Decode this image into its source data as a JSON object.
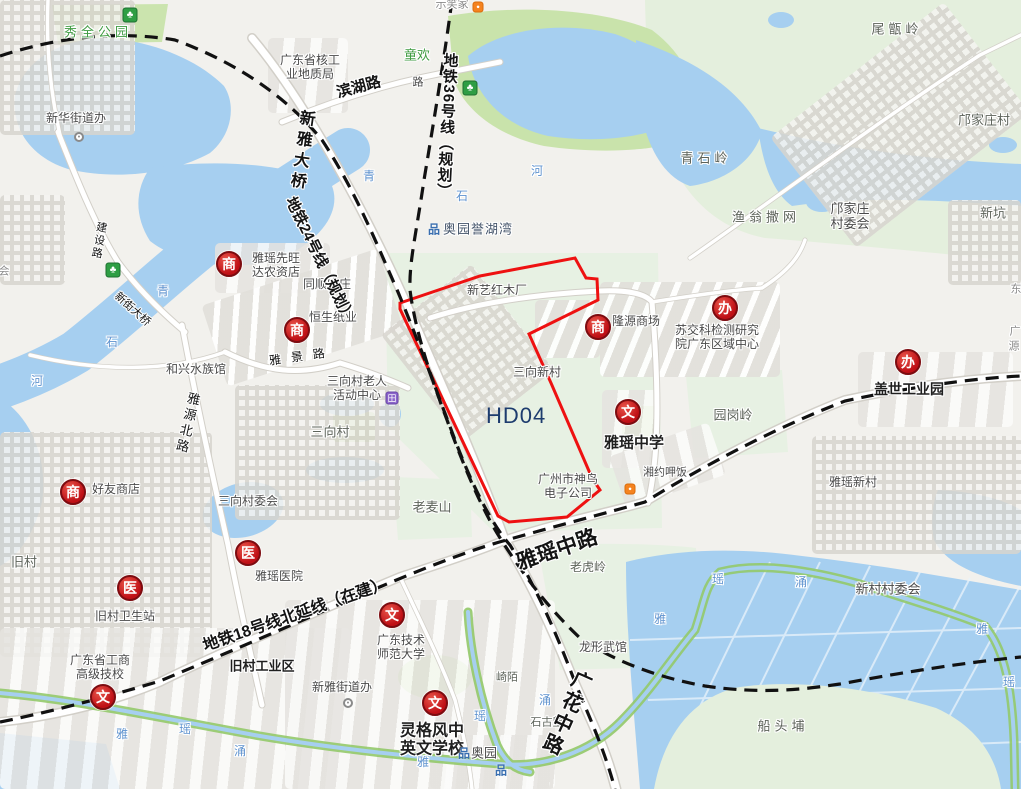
{
  "map": {
    "zone": {
      "code": "HD04",
      "boundary_color": "#ee1111",
      "label_color": "#1d3c6e"
    },
    "metro_lines": [
      {
        "label": "地铁24号线（规划）"
      },
      {
        "label": "地铁36号线（规划）"
      },
      {
        "label": "地铁18号线北延线（在建）"
      }
    ],
    "roads": [
      {
        "label": "滨湖路"
      },
      {
        "label": "新雅大桥"
      },
      {
        "label": "建设路"
      },
      {
        "label": "新街大桥"
      },
      {
        "label": "雅源北路"
      },
      {
        "label": "雅景路"
      },
      {
        "label": "雅瑶中路"
      },
      {
        "label": "广花中路"
      }
    ],
    "colors": {
      "water": "#a6cff0",
      "park_green": "#c9e3ab",
      "hill_green": "#e7f1e3",
      "poi_icon_red": "#bf1016"
    },
    "labels": [
      {
        "n": "xiuquan-park",
        "t": "秀全公园",
        "x": 98,
        "y": 33,
        "c": "green sp"
      },
      {
        "n": "xinhua-street-office",
        "t": "新华街道办",
        "x": 76,
        "y": 119,
        "c": ""
      },
      {
        "n": "nuclear-geology-bureau",
        "t": "广东省核工\n业地质局",
        "x": 310,
        "y": 68,
        "c": "pre"
      },
      {
        "n": "tonghuan",
        "t": "童欢",
        "x": 417,
        "y": 56,
        "c": "green"
      },
      {
        "n": "top-edge-clipped",
        "t": "示笑家",
        "x": 452,
        "y": 5,
        "c": "clip"
      },
      {
        "n": "small-road-char",
        "t": "路",
        "x": 418,
        "y": 83,
        "c": "",
        "fs": 11
      },
      {
        "n": "aoyuan-yuhuwan",
        "t": "奥园誉湖湾",
        "x": 478,
        "y": 230,
        "c": "slate"
      },
      {
        "n": "weizengling-hill",
        "t": "尾甑岭",
        "x": 897,
        "y": 30,
        "c": "place sp"
      },
      {
        "n": "kuangjiazhuang-village",
        "t": "邝家庄村",
        "x": 984,
        "y": 121,
        "c": "place"
      },
      {
        "n": "qingshiling-hill",
        "t": "青石岭",
        "x": 706,
        "y": 159,
        "c": "place sp"
      },
      {
        "n": "yuweng-sawang",
        "t": "渔翁撒网",
        "x": 766,
        "y": 218,
        "c": "place sp"
      },
      {
        "n": "kuangjiazhuang-committee",
        "t": "邝家庄\n村委会",
        "x": 850,
        "y": 217,
        "c": "pre",
        "fs": 13
      },
      {
        "n": "xinkeng",
        "t": "新坑",
        "x": 993,
        "y": 214,
        "c": "place"
      },
      {
        "n": "yayao-xianwangda-store",
        "t": "雅瑶先旺\n达农资店",
        "x": 276,
        "y": 266,
        "c": "pre"
      },
      {
        "n": "tongshun-farm",
        "t": "同顺农庄",
        "x": 327,
        "y": 285,
        "c": ""
      },
      {
        "n": "hengsheng-paper",
        "t": "恒生纸业",
        "x": 333,
        "y": 318,
        "c": ""
      },
      {
        "n": "xinyi-redwood-factory",
        "t": "新艺红木厂",
        "x": 497,
        "y": 291,
        "c": ""
      },
      {
        "n": "sanxiang-xincun",
        "t": "三向新村",
        "x": 537,
        "y": 373,
        "c": ""
      },
      {
        "n": "longyuan-mall",
        "t": "隆源商场",
        "x": 636,
        "y": 322,
        "c": ""
      },
      {
        "n": "sujiaoke-center",
        "t": "苏交科检测研究\n院广东区域中心",
        "x": 717,
        "y": 338,
        "c": "pre"
      },
      {
        "n": "hexing-aquarium",
        "t": "和兴水族馆",
        "x": 196,
        "y": 370,
        "c": ""
      },
      {
        "n": "elderly-activity-center",
        "t": "三向村老人\n活动中心",
        "x": 357,
        "y": 389,
        "c": "pre"
      },
      {
        "n": "sanxiang-village",
        "t": "三向村",
        "x": 330,
        "y": 433,
        "c": "place"
      },
      {
        "n": "yuangangling-hill",
        "t": "园岗岭",
        "x": 733,
        "y": 416,
        "c": "place"
      },
      {
        "n": "yayao-middle-school",
        "t": "雅瑶中学",
        "x": 634,
        "y": 443,
        "c": "big"
      },
      {
        "n": "gaishi-industrial-park",
        "t": "盖世工业园",
        "x": 909,
        "y": 389,
        "c": "big",
        "fs": 14
      },
      {
        "n": "haoyou-store",
        "t": "好友商店",
        "x": 116,
        "y": 490,
        "c": ""
      },
      {
        "n": "sanxiang-committee",
        "t": "三向村委会",
        "x": 248,
        "y": 502,
        "c": ""
      },
      {
        "n": "jiucun-village",
        "t": "旧村",
        "x": 24,
        "y": 563,
        "c": "place"
      },
      {
        "n": "yayao-hospital",
        "t": "雅瑶医院",
        "x": 279,
        "y": 577,
        "c": ""
      },
      {
        "n": "jiucun-clinic",
        "t": "旧村卫生站",
        "x": 125,
        "y": 617,
        "c": ""
      },
      {
        "n": "shenniao-electronics",
        "t": "广州市神鸟\n电子公司",
        "x": 568,
        "y": 487,
        "c": "pre"
      },
      {
        "n": "xiangyue-restaurant",
        "t": "湘约呷饭",
        "x": 665,
        "y": 473,
        "c": "",
        "fs": 11
      },
      {
        "n": "yayao-xincun",
        "t": "雅瑶新村",
        "x": 853,
        "y": 483,
        "c": ""
      },
      {
        "n": "xincun-committee",
        "t": "新村村委会",
        "x": 888,
        "y": 590,
        "c": "",
        "fs": 13
      },
      {
        "n": "chuantoubu",
        "t": "船头埔",
        "x": 783,
        "y": 727,
        "c": "place sp"
      },
      {
        "n": "laohuling-hill",
        "t": "老虎岭",
        "x": 588,
        "y": 568,
        "c": "place",
        "fs": 12
      },
      {
        "n": "longxing-martial-hall",
        "t": "龙形武馆",
        "x": 603,
        "y": 648,
        "c": ""
      },
      {
        "n": "laomaishan-hill",
        "t": "老麦山",
        "x": 432,
        "y": 508,
        "c": "place"
      },
      {
        "n": "qimo",
        "t": "崎陌",
        "x": 507,
        "y": 678,
        "c": "place",
        "fs": 11
      },
      {
        "n": "shigulang",
        "t": "石古塱",
        "x": 547,
        "y": 723,
        "c": "place",
        "fs": 11
      },
      {
        "n": "gongshang-technical-school",
        "t": "广东省工商\n高级技校",
        "x": 100,
        "y": 668,
        "c": "pre"
      },
      {
        "n": "jiucun-industrial-zone",
        "t": "旧村工业区",
        "x": 262,
        "y": 667,
        "c": "big",
        "fs": 13
      },
      {
        "n": "xinya-street-office",
        "t": "新雅街道办",
        "x": 342,
        "y": 688,
        "c": ""
      },
      {
        "n": "normal-university",
        "t": "广东技术\n师范大学",
        "x": 401,
        "y": 648,
        "c": "pre"
      },
      {
        "n": "linggefeng-school",
        "t": "灵格风中\n英文学校",
        "x": 432,
        "y": 741,
        "c": "big pre",
        "fs": 16
      },
      {
        "n": "aoyuan",
        "t": "奥园",
        "x": 484,
        "y": 754,
        "c": "",
        "fs": 13
      },
      {
        "n": "water-qing-1",
        "t": "青",
        "x": 369,
        "y": 177,
        "c": "blue"
      },
      {
        "n": "water-shi-1",
        "t": "石",
        "x": 462,
        "y": 197,
        "c": "blue"
      },
      {
        "n": "water-he-1",
        "t": "河",
        "x": 537,
        "y": 172,
        "c": "blue"
      },
      {
        "n": "water-qing-2",
        "t": "青",
        "x": 163,
        "y": 292,
        "c": "blue"
      },
      {
        "n": "water-shi-2",
        "t": "石",
        "x": 112,
        "y": 343,
        "c": "blue"
      },
      {
        "n": "water-he-2",
        "t": "河",
        "x": 37,
        "y": 382,
        "c": "blue"
      },
      {
        "n": "water-yao-1",
        "t": "瑶",
        "x": 718,
        "y": 580,
        "c": "blue"
      },
      {
        "n": "water-chong-1",
        "t": "涌",
        "x": 801,
        "y": 583,
        "c": "blue"
      },
      {
        "n": "water-ya-1",
        "t": "雅",
        "x": 660,
        "y": 620,
        "c": "blue"
      },
      {
        "n": "water-ya-2",
        "t": "雅",
        "x": 982,
        "y": 630,
        "c": "blue"
      },
      {
        "n": "water-yao-2",
        "t": "瑶",
        "x": 1009,
        "y": 683,
        "c": "blue"
      },
      {
        "n": "water-chong-2",
        "t": "涌",
        "x": 545,
        "y": 701,
        "c": "blue"
      },
      {
        "n": "water-yao-3",
        "t": "瑶",
        "x": 480,
        "y": 717,
        "c": "blue"
      },
      {
        "n": "water-ya-3",
        "t": "雅",
        "x": 423,
        "y": 763,
        "c": "blue"
      },
      {
        "n": "water-ya-4",
        "t": "雅",
        "x": 122,
        "y": 735,
        "c": "blue"
      },
      {
        "n": "water-yao-4",
        "t": "瑶",
        "x": 185,
        "y": 730,
        "c": "blue"
      },
      {
        "n": "water-chong-3",
        "t": "涌",
        "x": 240,
        "y": 752,
        "c": "blue"
      },
      {
        "n": "left-edge-clipped",
        "t": "会",
        "x": 4,
        "y": 272,
        "c": "clip"
      },
      {
        "n": "right-edge-clipped-1",
        "t": "东",
        "x": 1016,
        "y": 290,
        "c": "clip"
      },
      {
        "n": "right-edge-clipped-2",
        "t": "广",
        "x": 1015,
        "y": 332,
        "c": "clip"
      },
      {
        "n": "right-edge-clipped-3",
        "t": "源",
        "x": 1014,
        "y": 347,
        "c": "clip"
      }
    ],
    "icons": [
      {
        "k": "red",
        "g": "商",
        "x": 229,
        "y": 264,
        "n": "commerce-icon-1"
      },
      {
        "k": "red",
        "g": "商",
        "x": 297,
        "y": 330,
        "n": "commerce-icon-2"
      },
      {
        "k": "red",
        "g": "商",
        "x": 598,
        "y": 327,
        "n": "commerce-icon-3"
      },
      {
        "k": "red",
        "g": "商",
        "x": 73,
        "y": 492,
        "n": "commerce-icon-4"
      },
      {
        "k": "red",
        "g": "医",
        "x": 248,
        "y": 553,
        "n": "hospital-icon-1"
      },
      {
        "k": "red",
        "g": "医",
        "x": 130,
        "y": 588,
        "n": "hospital-icon-2"
      },
      {
        "k": "red",
        "g": "办",
        "x": 725,
        "y": 308,
        "n": "office-icon-1"
      },
      {
        "k": "red",
        "g": "办",
        "x": 908,
        "y": 362,
        "n": "office-icon-2"
      },
      {
        "k": "red",
        "g": "文",
        "x": 628,
        "y": 412,
        "n": "culture-icon-1"
      },
      {
        "k": "red",
        "g": "文",
        "x": 392,
        "y": 615,
        "n": "culture-icon-2"
      },
      {
        "k": "red",
        "g": "文",
        "x": 435,
        "y": 703,
        "n": "culture-icon-3"
      },
      {
        "k": "red",
        "g": "文",
        "x": 103,
        "y": 697,
        "n": "culture-icon-4"
      },
      {
        "k": "tree",
        "g": "♣",
        "x": 130,
        "y": 15,
        "n": "park-icon-1"
      },
      {
        "k": "tree",
        "g": "♣",
        "x": 470,
        "y": 88,
        "n": "park-icon-2"
      },
      {
        "k": "tree",
        "g": "♣",
        "x": 113,
        "y": 270,
        "n": "park-icon-3"
      },
      {
        "k": "orange",
        "g": "●",
        "x": 478,
        "y": 7,
        "n": "poi-orange-icon-1"
      },
      {
        "k": "orange",
        "g": "●",
        "x": 630,
        "y": 489,
        "n": "poi-orange-icon-2"
      },
      {
        "k": "purple",
        "g": "田",
        "x": 392,
        "y": 398,
        "n": "community-center-icon"
      },
      {
        "k": "bldg",
        "g": "品",
        "x": 434,
        "y": 229,
        "n": "building-icon-1"
      },
      {
        "k": "bldg",
        "g": "品",
        "x": 464,
        "y": 753,
        "n": "building-icon-2"
      },
      {
        "k": "bldg",
        "g": "品",
        "x": 501,
        "y": 770,
        "n": "building-icon-3"
      },
      {
        "k": "ring",
        "g": "•",
        "x": 79,
        "y": 137,
        "n": "gov-marker-icon-1"
      },
      {
        "k": "ring",
        "g": "•",
        "x": 348,
        "y": 703,
        "n": "gov-marker-icon-2"
      }
    ]
  }
}
